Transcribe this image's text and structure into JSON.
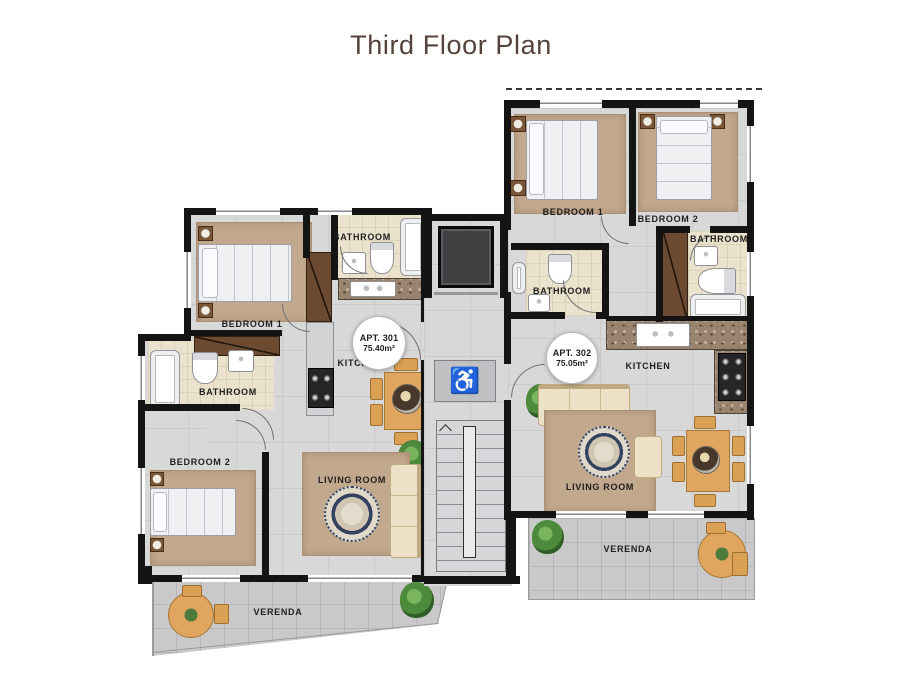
{
  "title": "Third Floor Plan",
  "colors": {
    "title_text": "#55423a",
    "wall": "#141414",
    "floor_tile": "#d8d8d9",
    "bath_tile": "#eae2cd",
    "veranda_tile": "#c9c9ca",
    "rug": "#c2a88c",
    "wood": "#e0a55e",
    "wardrobe": "#6b4a31",
    "sofa": "#ede2c8",
    "plant": "#4d8a3b",
    "granite": "#998470",
    "label_text": "#1e1e1e"
  },
  "core": {
    "accessible_icon": "♿"
  },
  "apt301": {
    "badge_title": "APT. 301",
    "badge_area": "75.40m²",
    "bedroom1_label": "BEDROOM 1",
    "bedroom2_label": "BEDROOM 2",
    "bathroom_top_label": "BATHROOM",
    "bathroom_side_label": "BATHROOM",
    "kitchen_label": "KITCHEN",
    "living_room_label": "LIVING ROOM",
    "veranda_label": "VERENDA"
  },
  "apt302": {
    "badge_title": "APT. 302",
    "badge_area": "75.05m²",
    "bedroom1_label": "BEDROOM 1",
    "bedroom2_label": "BEDROOM 2",
    "bathroom_left_label": "BATHROOM",
    "bathroom_right_label": "BATHROOM",
    "kitchen_label": "KITCHEN",
    "living_room_label": "LIVING ROOM",
    "veranda_label": "VERENDA"
  }
}
